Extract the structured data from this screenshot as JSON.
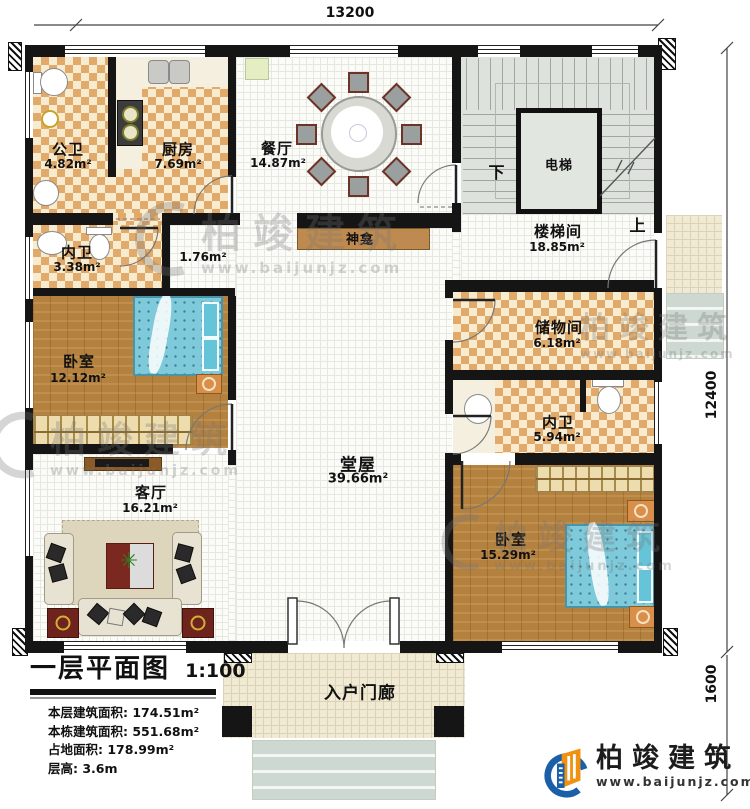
{
  "dimensions": {
    "top_width": "13200",
    "right_height": "12400",
    "porch_height": "1600"
  },
  "rooms": {
    "gongwei": {
      "label": "公卫",
      "area": "4.82m²"
    },
    "chufang": {
      "label": "厨房",
      "area": "7.69m²"
    },
    "canting": {
      "label": "餐厅",
      "area": "14.87m²"
    },
    "shenkan": {
      "label": "神龛",
      "area": "1.76m²"
    },
    "dianti": {
      "label": "电梯"
    },
    "loutijian": {
      "label": "楼梯间",
      "area": "18.85m²"
    },
    "neiwei_north": {
      "label": "内卫",
      "area": "3.38m²"
    },
    "chuwujian": {
      "label": "储物间",
      "area": "6.18m²"
    },
    "woshi_west": {
      "label": "卧室",
      "area": "12.12m²"
    },
    "neiwei_east": {
      "label": "内卫",
      "area": "5.94m²"
    },
    "tangwu": {
      "label": "堂屋",
      "area": "39.66m²"
    },
    "keting": {
      "label": "客厅",
      "area": "16.21m²"
    },
    "woshi_east": {
      "label": "卧室",
      "area": "15.29m²"
    },
    "rumenlang": {
      "label": "入户门廊"
    }
  },
  "stairs": {
    "down": "下",
    "up": "上"
  },
  "title_block": {
    "title": "一层平面图",
    "scale": "1:100",
    "stats": [
      {
        "label": "本层建筑面积:",
        "value": "174.51m²"
      },
      {
        "label": "本栋建筑面积:",
        "value": "551.68m²"
      },
      {
        "label": "占地面积:",
        "value": "178.99m²"
      },
      {
        "label": "层高:",
        "value": "3.6m"
      }
    ]
  },
  "logo": {
    "name": "柏竣建筑",
    "website": "www.baijunjz.com"
  },
  "watermark": {
    "name": "柏竣建筑",
    "website": "www.baijunjz.com"
  }
}
